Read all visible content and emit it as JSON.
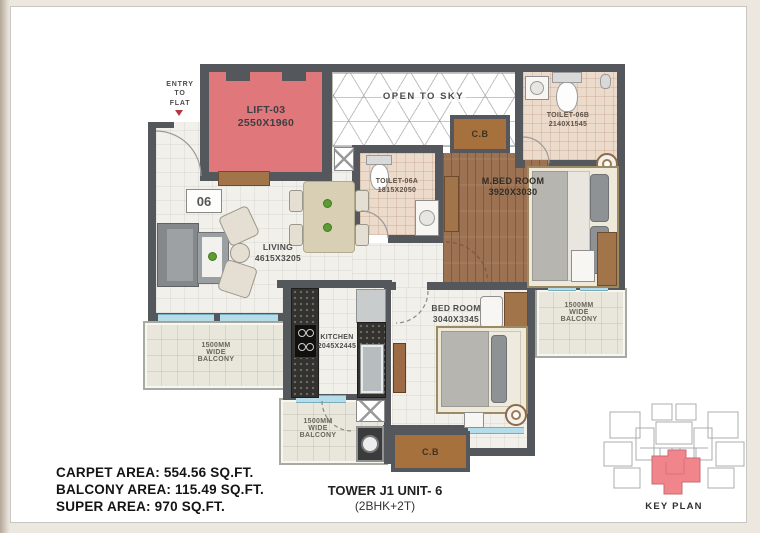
{
  "entry": {
    "label": "ENTRY\nTO\nFLAT"
  },
  "unit_badge": "06",
  "rooms": {
    "lift": {
      "name": "LIFT-03",
      "dims": "2550X1960"
    },
    "open_to_sky": {
      "name": "OPEN TO SKY"
    },
    "toilet_06b": {
      "name": "TOILET-06B",
      "dims": "2140X1545"
    },
    "toilet_06a": {
      "name": "TOILET-06A",
      "dims": "1815X2050"
    },
    "master_bedroom": {
      "name": "M.BED ROOM",
      "dims": "3920X3030"
    },
    "living": {
      "name": "LIVING",
      "dims": "4615X3205"
    },
    "kitchen": {
      "name": "KITCHEN",
      "dims": "2045X2445"
    },
    "bedroom": {
      "name": "BED ROOM",
      "dims": "3040X3345"
    },
    "balcony_left": {
      "name": "1500MM\nWIDE\nBALCONY"
    },
    "balcony_bottom": {
      "name": "1500MM\nWIDE\nBALCONY"
    },
    "balcony_right": {
      "name": "1500MM\nWIDE\nBALCONY"
    },
    "cupboard_top": {
      "name": "C.B"
    },
    "cupboard_bottom": {
      "name": "C.B"
    }
  },
  "summary": {
    "carpet_area": "CARPET AREA: 554.56 SQ.FT.",
    "balcony_area": "BALCONY AREA: 115.49 SQ.FT.",
    "super_area": "SUPER AREA: 970 SQ.FT.",
    "tower": "TOWER J1 UNIT- 6",
    "config": "(2BHK+2T)"
  },
  "key_plan": {
    "label": "KEY PLAN"
  },
  "colors": {
    "wall": "#54585c",
    "lift_fill": "#e0777b",
    "wood_floor": "#9c7252",
    "toilet_floor": "#ecdbcb",
    "cupboard": "#a6713d",
    "window": "#b5dde9",
    "keyplan_highlight": "#f0868b"
  }
}
